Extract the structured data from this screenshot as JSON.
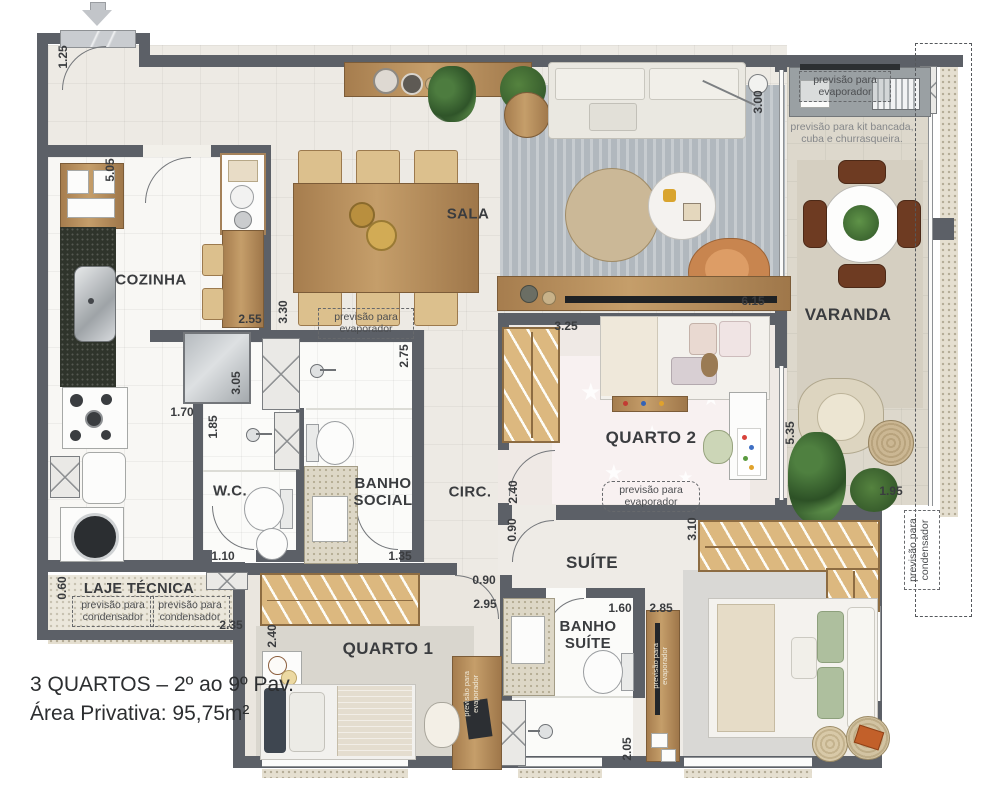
{
  "plan": {
    "footer_line1": "3 QUARTOS – 2º ao 9º Pav.",
    "footer_line2": "Área Privativa: 95,75m²"
  },
  "rooms": {
    "cozinha": "COZINHA",
    "sala": "SALA",
    "varanda": "VARANDA",
    "quarto2": "QUARTO 2",
    "circ": "CIRC.",
    "wc": "W.C.",
    "banho_social": "BANHO SOCIAL",
    "suite": "SUÍTE",
    "banho_suite": "BANHO SUÍTE",
    "quarto1": "QUARTO 1",
    "laje_tecnica": "LAJE TÉCNICA"
  },
  "annotations": {
    "evaporador": "previsão para evaporador",
    "condensador": "previsão para condensador",
    "kit_churrasqueira": "previsão para kit bancada, cuba e churrasqueira."
  },
  "dims": {
    "entry_height": "1.25",
    "kitchen_length": "5.05",
    "kitchen_table": "2.55",
    "hall_width": "3.30",
    "kitchen_door": "3.05",
    "kitchen_width": "1.70",
    "wc_length": "1.85",
    "banho_social_length": "2.75",
    "wc_width": "1.10",
    "banho_social_width": "1.35",
    "sala_width": "3.00",
    "sala_length": "6.15",
    "quarto2_width": "3.25",
    "quarto2_door": "2.40",
    "circ_opening": "0.90",
    "quarto1_door": "0.90",
    "quarto1_width": "2.95",
    "varanda_length": "5.35",
    "varanda_width": "1.95",
    "suite_width": "3.10",
    "banho_suite_width": "1.60",
    "suite_entry": "2.85",
    "banho_suite_length": "2.05",
    "laje_width": "0.60",
    "laje_length": "2.35",
    "quarto1_length": "2.40"
  }
}
